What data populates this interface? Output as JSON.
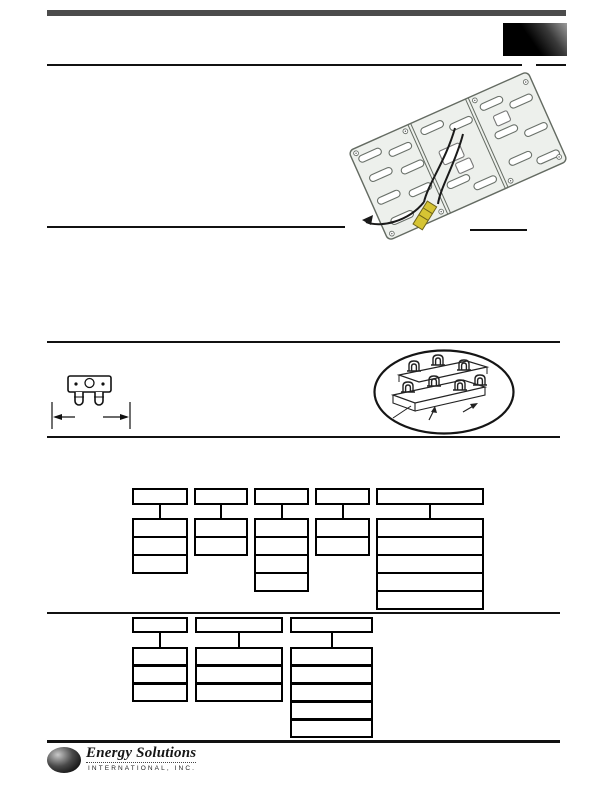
{
  "document": {
    "kind": "product-datasheet-page",
    "visible_text_note": "page body text not rendered in source scan; only line art, rules, empty model-code boxes and footer logo are visible",
    "footer_logo": {
      "company": "Energy Solutions",
      "subtitle": "INTERNATIONAL, INC."
    }
  },
  "colors": {
    "header_bar": "#4c4c4c",
    "rule": "#111111",
    "logo_box_dark": "#000000",
    "logo_box_light": "#9c9c9c",
    "panel_body": "#edf0ec",
    "panel_line": "#646b62",
    "wire": "#1a1a1a",
    "connector_yellow": "#d6c433",
    "globe": "#161616"
  },
  "illustrations": {
    "panel_assembly": "rotated three-section heating-element mounting panel with slots, wires and yellow quick-connect plug",
    "fuse_component": "small two-prong thermal fuse with blank width dimension callout",
    "terminal_detail": "oval inset: isometric detail of ceramic terminal insulators on mounting rails"
  },
  "upper_chart": {
    "header_y": 488,
    "header_h": 17,
    "stack_y": 518,
    "row_h": 16,
    "border": 2,
    "divider": 2,
    "columns": [
      {
        "x": 132,
        "w": 56,
        "rows": 3
      },
      {
        "x": 194,
        "w": 54,
        "rows": 2
      },
      {
        "x": 254,
        "w": 55,
        "rows": 4
      },
      {
        "x": 315,
        "w": 55,
        "rows": 2
      },
      {
        "x": 376,
        "w": 108,
        "rows": 5
      }
    ]
  },
  "lower_chart": {
    "header_y": 617,
    "header_h": 16,
    "stack_y": 647,
    "row_h": 15,
    "border": 2,
    "divider": 3,
    "columns": [
      {
        "x": 132,
        "w": 56,
        "rows": 3
      },
      {
        "x": 195,
        "w": 88,
        "rows": 3
      },
      {
        "x": 290,
        "w": 83,
        "rows": 5
      }
    ]
  }
}
